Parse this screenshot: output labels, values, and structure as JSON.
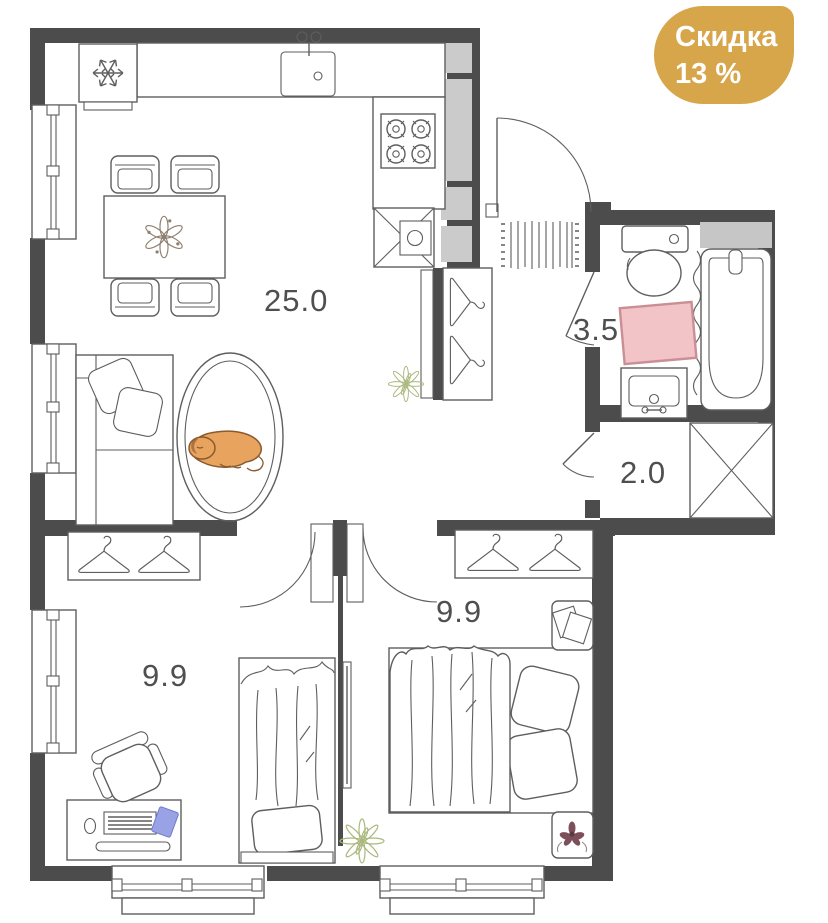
{
  "badge": {
    "text_line1": "Скидка",
    "text_line2": "13 %",
    "background": "#D7A64B",
    "text_color": "#FFFFFF"
  },
  "floorplan": {
    "rooms": {
      "kitchen_living": {
        "label": "25.0"
      },
      "bathroom": {
        "label": "3.5"
      },
      "hallway": {
        "label": "2.0"
      },
      "bedroom_left": {
        "label": "9.9"
      },
      "bedroom_right": {
        "label": "9.9"
      }
    },
    "icons": {
      "fridge": "snowflake-icon",
      "stove": "four-burners-icon",
      "wardrobes": "hanger-icon",
      "washing_machine": "crossed-box-icon",
      "built_in_closet": "crossed-box-icon"
    }
  },
  "colors": {
    "wall": "#4C4C4C",
    "line": "#5E5E5E",
    "shaft": "#CBCBCB",
    "shelf": "#C6C6C6",
    "label": "#4F4F4F",
    "badge": "#D7A64B",
    "badgefg": "#FFFFFF",
    "rug": "#F2C4C7",
    "rugline": "#C98F94",
    "dog": "#E8A35E",
    "dogline": "#8A5A2F",
    "plant": "#A9B87C",
    "book": "#9AA2E6",
    "bookline": "#717AC9",
    "flower": "#7D4F5A"
  }
}
